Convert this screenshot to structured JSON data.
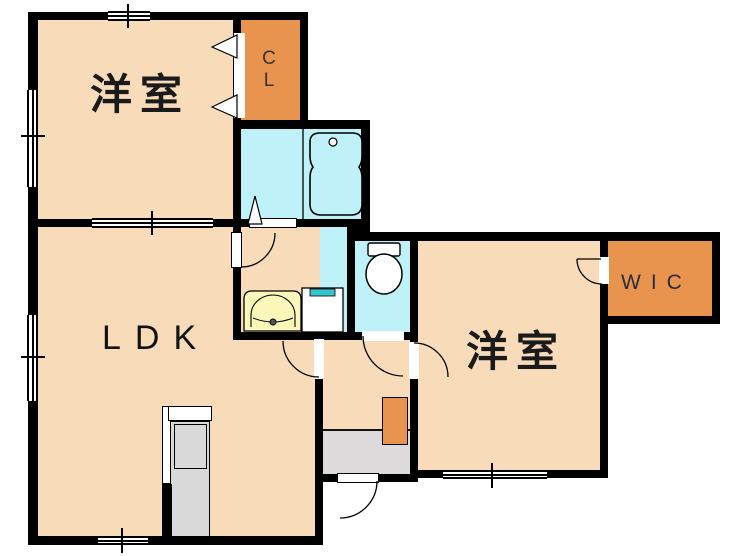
{
  "floorplan": {
    "labels": {
      "bedroom_top_left": "洋室",
      "closet": "CL",
      "living_dining_kitchen": "LDK",
      "bedroom_right": "洋室",
      "walk_in_closet": "WIC"
    },
    "colors": {
      "room_beige": "#F8DCBA",
      "closet_orange": "#E8944E",
      "wet_area_cyan": "#BFF2F8",
      "basin_yellow": "#FBF7B8",
      "washer_teal": "#35C4CD",
      "entrance_gray": "#DEDADB",
      "kitchen_gray": "#D9D9D9",
      "wall_black": "#000000"
    },
    "fixture_icons": [
      "bathtub-icon",
      "toilet-icon",
      "washbasin-icon",
      "washing-machine-icon",
      "kitchen-unit-icon",
      "shoe-cabinet-icon",
      "door-swing-icon",
      "folding-door-icon",
      "window-icon"
    ]
  }
}
